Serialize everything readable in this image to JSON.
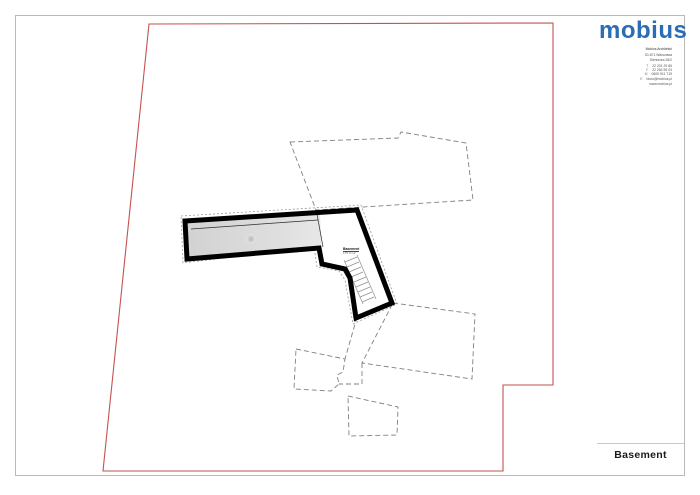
{
  "header": {
    "logo_text": "mobius",
    "contact": {
      "company": "Mobius Architekci",
      "address_line1": "00-871 Warszawa",
      "address_line2": "Siennicka 28/2",
      "phone_rows": [
        {
          "k": "T",
          "v": "22 201 29 86"
        },
        {
          "k": "F",
          "v": "22 254 59 03"
        },
        {
          "k": "M",
          "v": "0609 911 719"
        },
        {
          "k": "E",
          "v": "biuro@mobius.pl"
        }
      ],
      "website": "www.mobius.pl"
    }
  },
  "plan": {
    "room_label": "Basement",
    "room_sublabel": "175.0 m2"
  },
  "title_block": {
    "title": "Basement"
  },
  "colors": {
    "logo_blue": "#2a6db5",
    "boundary_red": "#c4524e",
    "dashed_gray": "#808080",
    "wall_black": "#000000"
  }
}
